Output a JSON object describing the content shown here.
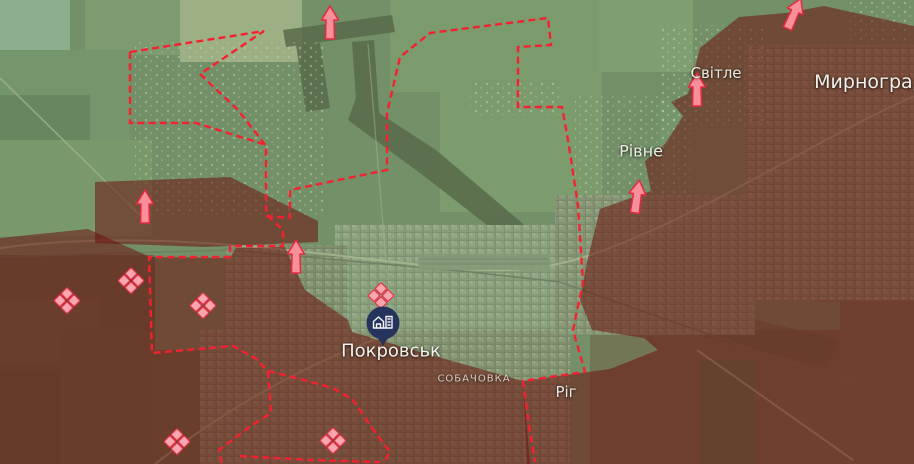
{
  "map": {
    "place_labels": [
      {
        "id": "pokrovsk",
        "text": "Покровськ",
        "x": 391,
        "y": 351,
        "size": 18,
        "kind": "city"
      },
      {
        "id": "sobachovka",
        "text": "СОБАЧОВКА",
        "x": 474,
        "y": 379,
        "size": 10,
        "kind": "district"
      },
      {
        "id": "myrnohrad",
        "text": "Мирноград",
        "x": 870,
        "y": 82,
        "size": 19,
        "kind": "city"
      },
      {
        "id": "svitle",
        "text": "Світле",
        "x": 716,
        "y": 73,
        "size": 15,
        "kind": "town"
      },
      {
        "id": "rivne",
        "text": "Рівне",
        "x": 641,
        "y": 151,
        "size": 16,
        "kind": "town"
      },
      {
        "id": "rih",
        "text": "Ріг",
        "x": 566,
        "y": 392,
        "size": 15,
        "kind": "town"
      }
    ],
    "attack_arrows": [
      {
        "x": 330,
        "y": 23,
        "rotation": 0
      },
      {
        "x": 145,
        "y": 207,
        "rotation": 0
      },
      {
        "x": 296,
        "y": 257,
        "rotation": 0
      },
      {
        "x": 697,
        "y": 90,
        "rotation": 0
      },
      {
        "x": 637,
        "y": 197,
        "rotation": 8
      },
      {
        "x": 794,
        "y": 14,
        "rotation": 24
      }
    ],
    "fortification_markers": [
      {
        "x": 67,
        "y": 301
      },
      {
        "x": 131,
        "y": 281
      },
      {
        "x": 203,
        "y": 306
      },
      {
        "x": 381,
        "y": 296
      },
      {
        "x": 177,
        "y": 442
      },
      {
        "x": 333,
        "y": 441
      }
    ],
    "poi_marker": {
      "x": 383,
      "y": 323,
      "icon": "settlement-buildings-icon"
    },
    "frontline_paths": [
      "M130,52 L264,31 L200,74 L238,110 L266,146 L266,214 L283,230 L283,246 L230,246 L230,257 L149,257 L152,353 L233,346 L255,358 L268,371 L271,413 L248,428 L219,450 L222,464",
      "M130,52 L130,123 L196,123 L263,144",
      "M266,216 L290,218 L290,190 L387,170 L387,113 L400,57 L430,33 L548,18 L551,45 L518,47 L518,107 L562,107 L568,140 L578,205 L583,283 L573,330 L585,372 L523,381 L529,425 L535,462",
      "M268,371 L300,379 L333,388 L353,400 L372,428 L390,452 L383,464",
      "M240,456 L310,460 L380,462"
    ],
    "zones": {
      "liberated": [
        "0,0 914,0 914,464 0,464"
      ],
      "occupied": [
        "739,17 786,13 824,6 914,26 914,464 527,464 523,381 610,369 658,350 644,338 592,330 580,300 587,262 600,209 651,191 645,161 665,144 683,116 671,102 688,94 700,48",
        "0,238 88,229 150,257 230,258 236,248 285,247 290,258 305,290 348,320 352,332 420,352 470,366 523,381 530,464 0,464",
        "95,182 230,177 318,221 318,242 205,247 95,243"
      ]
    },
    "colors": {
      "frontline": "#f5212e",
      "liberated": "#7fb97f",
      "occupied": "#6b130e",
      "arrow_fill": "#f8909c",
      "arrow_stroke": "#e32a40",
      "fortification_fill": "#f9a6b0",
      "fortification_stroke": "#e23348",
      "poi_fill": "#26335c",
      "poi_icon": "#f4f4f6",
      "label_color": "#f3f1ec"
    }
  }
}
